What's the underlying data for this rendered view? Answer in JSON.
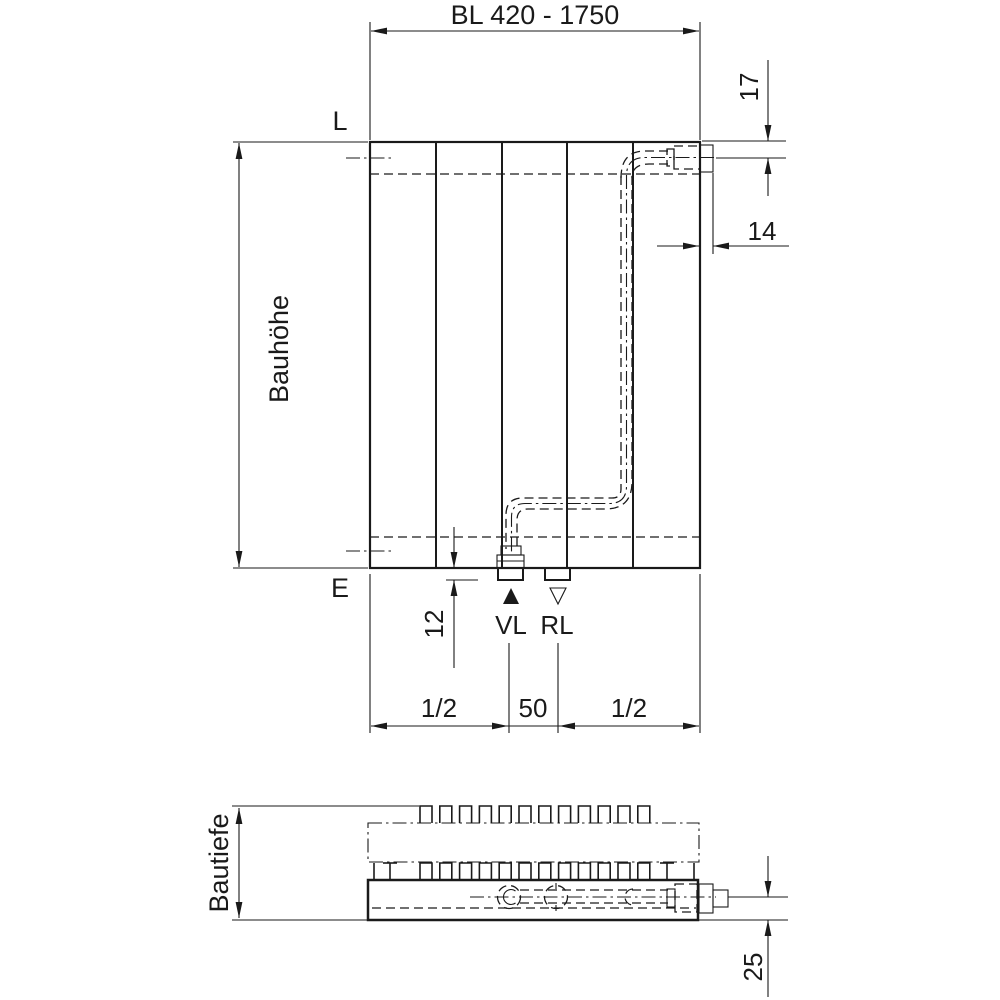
{
  "front_view": {
    "length_dim": "BL 420 - 1750",
    "height_dim": "Bauhöhe",
    "top_level_label": "L",
    "bottom_level_label": "E",
    "top_offset_dim": "17",
    "nipple_depth_dim": "14",
    "bottom_offset_dim": "12",
    "supply_label": "VL",
    "return_label": "RL",
    "left_span_dim": "1/2",
    "center_span_dim": "50",
    "right_span_dim": "1/2"
  },
  "section_view": {
    "depth_dim": "Bautiefe",
    "pipe_center_offset_dim": "25"
  },
  "colors": {
    "line": "#1a1a1a",
    "background": "#ffffff"
  }
}
